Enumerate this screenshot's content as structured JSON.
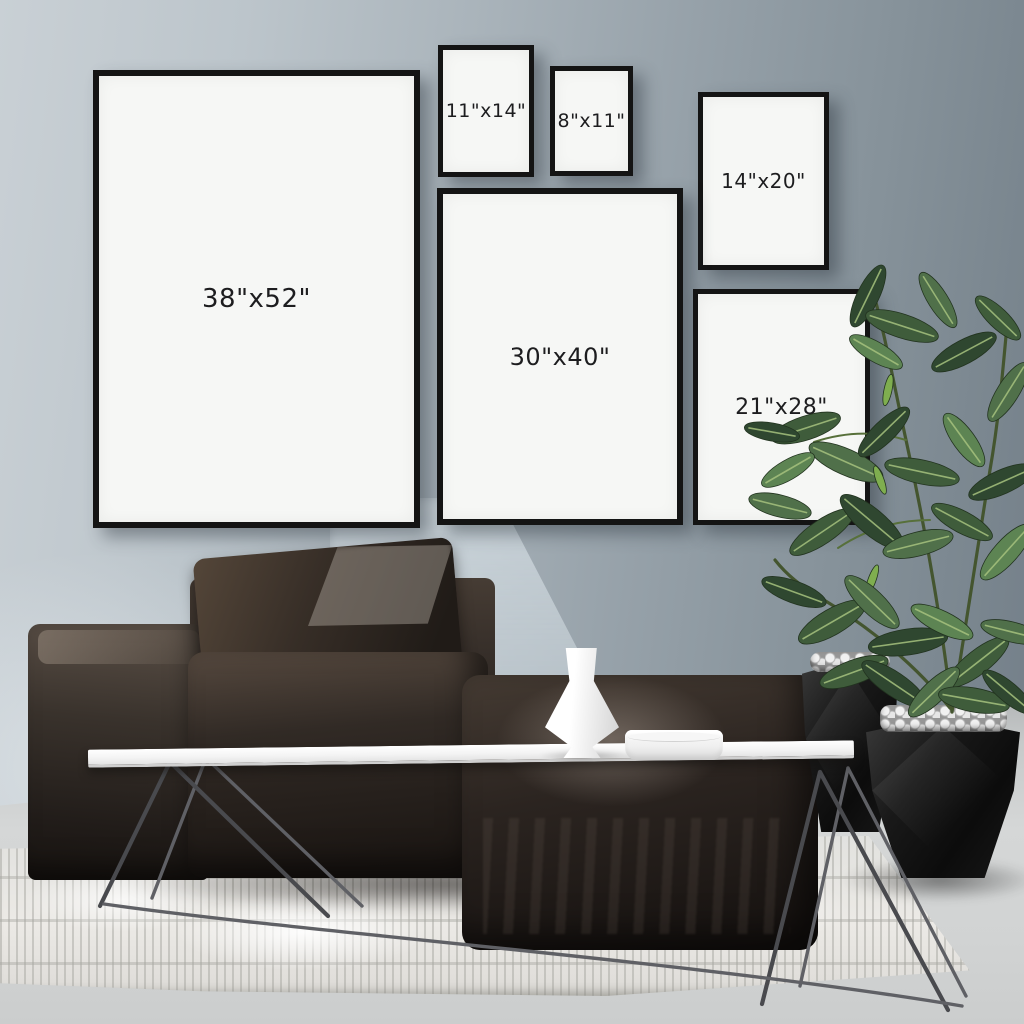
{
  "frames": [
    {
      "id": "38x52",
      "label": "38\"x52\""
    },
    {
      "id": "11x14",
      "label": "11\"x14\""
    },
    {
      "id": "8x11",
      "label": "8\"x11\""
    },
    {
      "id": "14x20",
      "label": "14\"x20\""
    },
    {
      "id": "30x40",
      "label": "30\"x40\""
    },
    {
      "id": "21x28",
      "label": "21\"x28\""
    }
  ],
  "colors": {
    "wall_light": "#c9d0d5",
    "wall_dark": "#747f89",
    "frame_border": "#141414",
    "frame_mat": "#f6f7f5",
    "label_text": "#1d1d1f",
    "sofa": "#241f1c",
    "rug": "#eceae6",
    "floor": "#d1d3d3",
    "table_top": "#ffffff",
    "planter": "#0c0c0c",
    "plant_green": "#3f5c3b"
  }
}
